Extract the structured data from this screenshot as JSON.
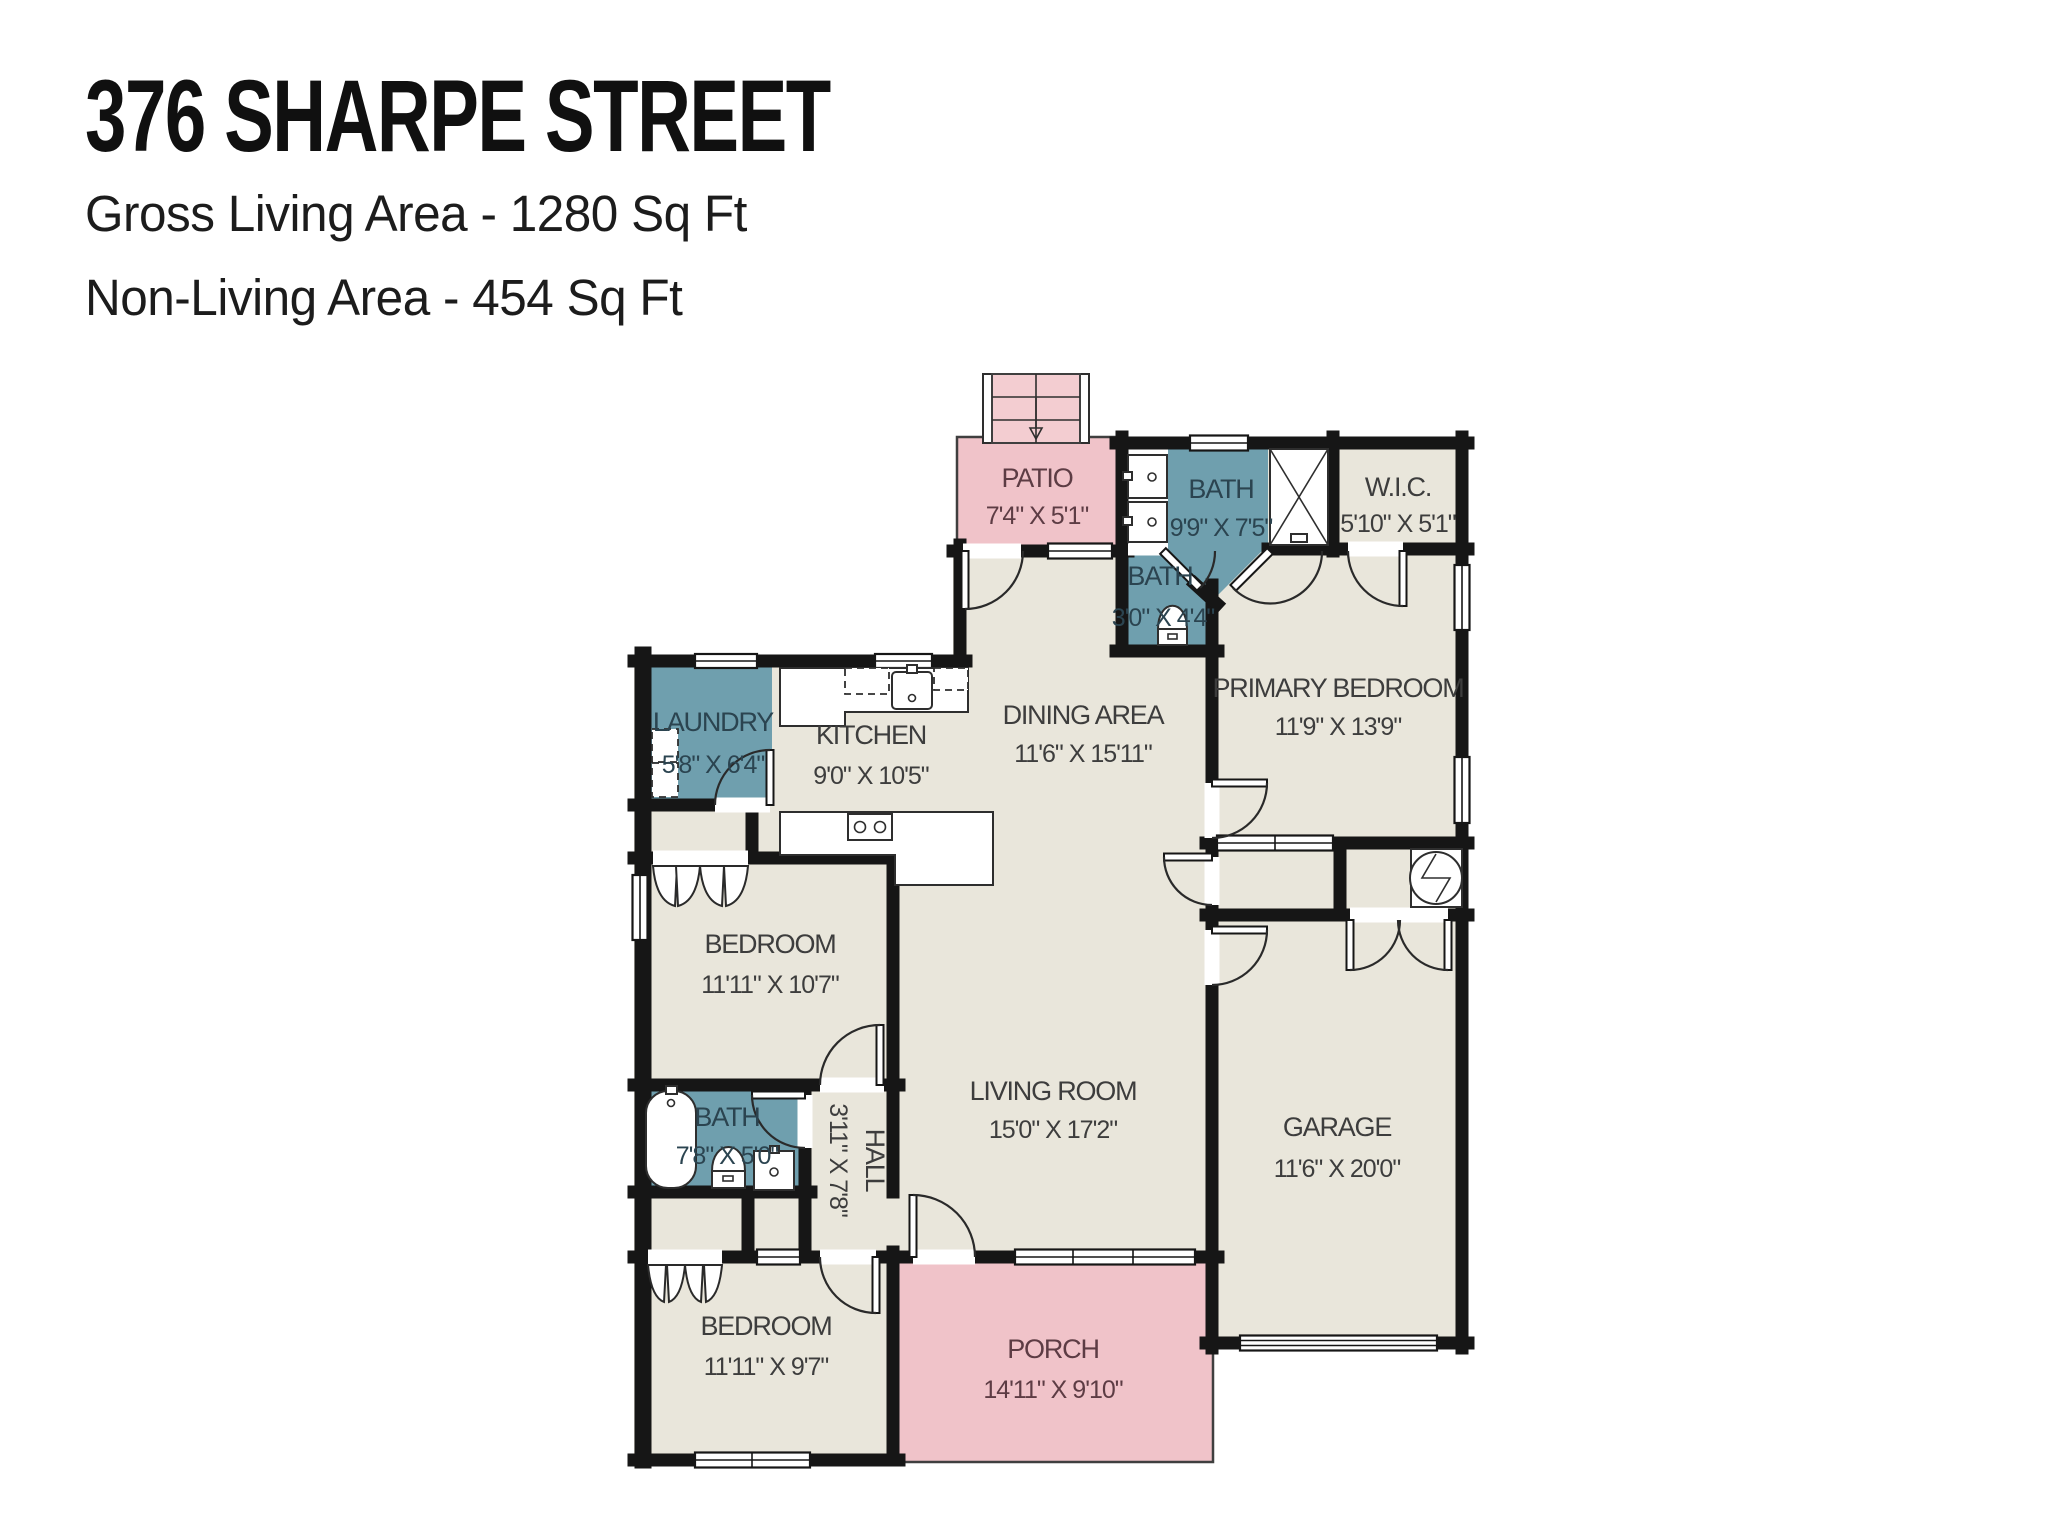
{
  "header": {
    "title": "376 SHARPE STREET",
    "line1": "Gross Living Area - 1280 Sq Ft",
    "line2": "Non-Living Area - 454 Sq Ft"
  },
  "rooms": {
    "patio": {
      "name": "PATIO",
      "dims": "7'4\" X 5'1\""
    },
    "bath1": {
      "name": "BATH",
      "dims": "9'9\" X 7'5\""
    },
    "wic": {
      "name": "W.I.C.",
      "dims": "5'10\" X 5'1\""
    },
    "bath2": {
      "name": "BATH",
      "dims": "3'0\" X 4'4\""
    },
    "primary": {
      "name": "PRIMARY BEDROOM",
      "dims": "11'9\" X 13'9\""
    },
    "laundry": {
      "name": "LAUNDRY",
      "dims": "5'8\" X 6'4\""
    },
    "kitchen": {
      "name": "KITCHEN",
      "dims": "9'0\" X 10'5\""
    },
    "dining": {
      "name": "DINING AREA",
      "dims": "11'6\" X 15'11\""
    },
    "bedroom1": {
      "name": "BEDROOM",
      "dims": "11'11\" X 10'7\""
    },
    "living": {
      "name": "LIVING ROOM",
      "dims": "15'0\" X 17'2\""
    },
    "garage": {
      "name": "GARAGE",
      "dims": "11'6\" X 20'0\""
    },
    "bath3": {
      "name": "BATH",
      "dims": "7'8\" X 5'0\""
    },
    "hall": {
      "name": "HALL",
      "dims": "3'11\" X 7'8\""
    },
    "bedroom2": {
      "name": "BEDROOM",
      "dims": "11'11\" X 9'7\""
    },
    "porch": {
      "name": "PORCH",
      "dims": "14'11\" X 9'10\""
    }
  },
  "colors": {
    "wall": "#161616",
    "floor": "#e9e6db",
    "wet": "#6f9fae",
    "outdoor": "#f0c3c9",
    "steps": "#f3cdd1",
    "text": "#3d3d3d"
  }
}
